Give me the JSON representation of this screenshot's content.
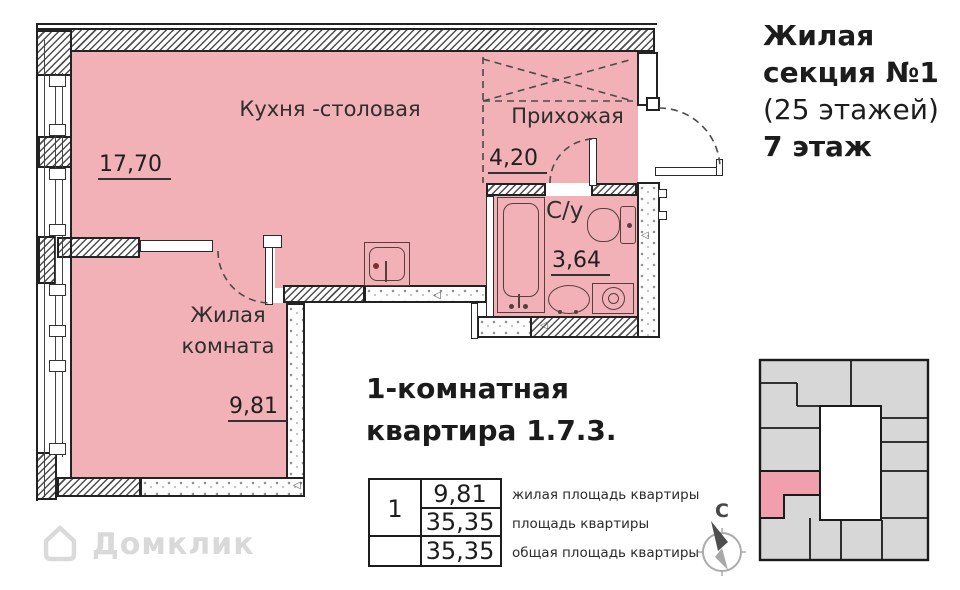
{
  "plan": {
    "rooms": {
      "kitchen": {
        "label": "Кухня -столовая",
        "area": "17,70"
      },
      "hallway": {
        "label": "Прихожая",
        "area": "4,20"
      },
      "bathroom": {
        "label": "С/у",
        "area": "3,64"
      },
      "living": {
        "label": "Жилая комната",
        "area": "9,81"
      }
    }
  },
  "title_block": {
    "line1": "Жилая",
    "line2": "секция №1",
    "line3": "(25 этажей)",
    "line4": "7 этаж"
  },
  "apartment_info": {
    "heading_line1": "1-комнатная",
    "heading_line2": "квартира 1.7.3.",
    "table": {
      "unit_number": "1",
      "rows": [
        {
          "value": "9,81",
          "label": "жилая площадь квартиры"
        },
        {
          "value": "35,35",
          "label": "площадь квартиры"
        },
        {
          "value": "35,35",
          "label": "общая площадь квартиры"
        }
      ]
    }
  },
  "key_plan": {
    "north_label": "С",
    "highlight_color": "#f19fad",
    "unit_color": "#d7d7d7"
  },
  "watermark": {
    "text": "Домклик"
  },
  "colors": {
    "room_fill": "#f2b1b7",
    "wall_line": "#222222"
  }
}
